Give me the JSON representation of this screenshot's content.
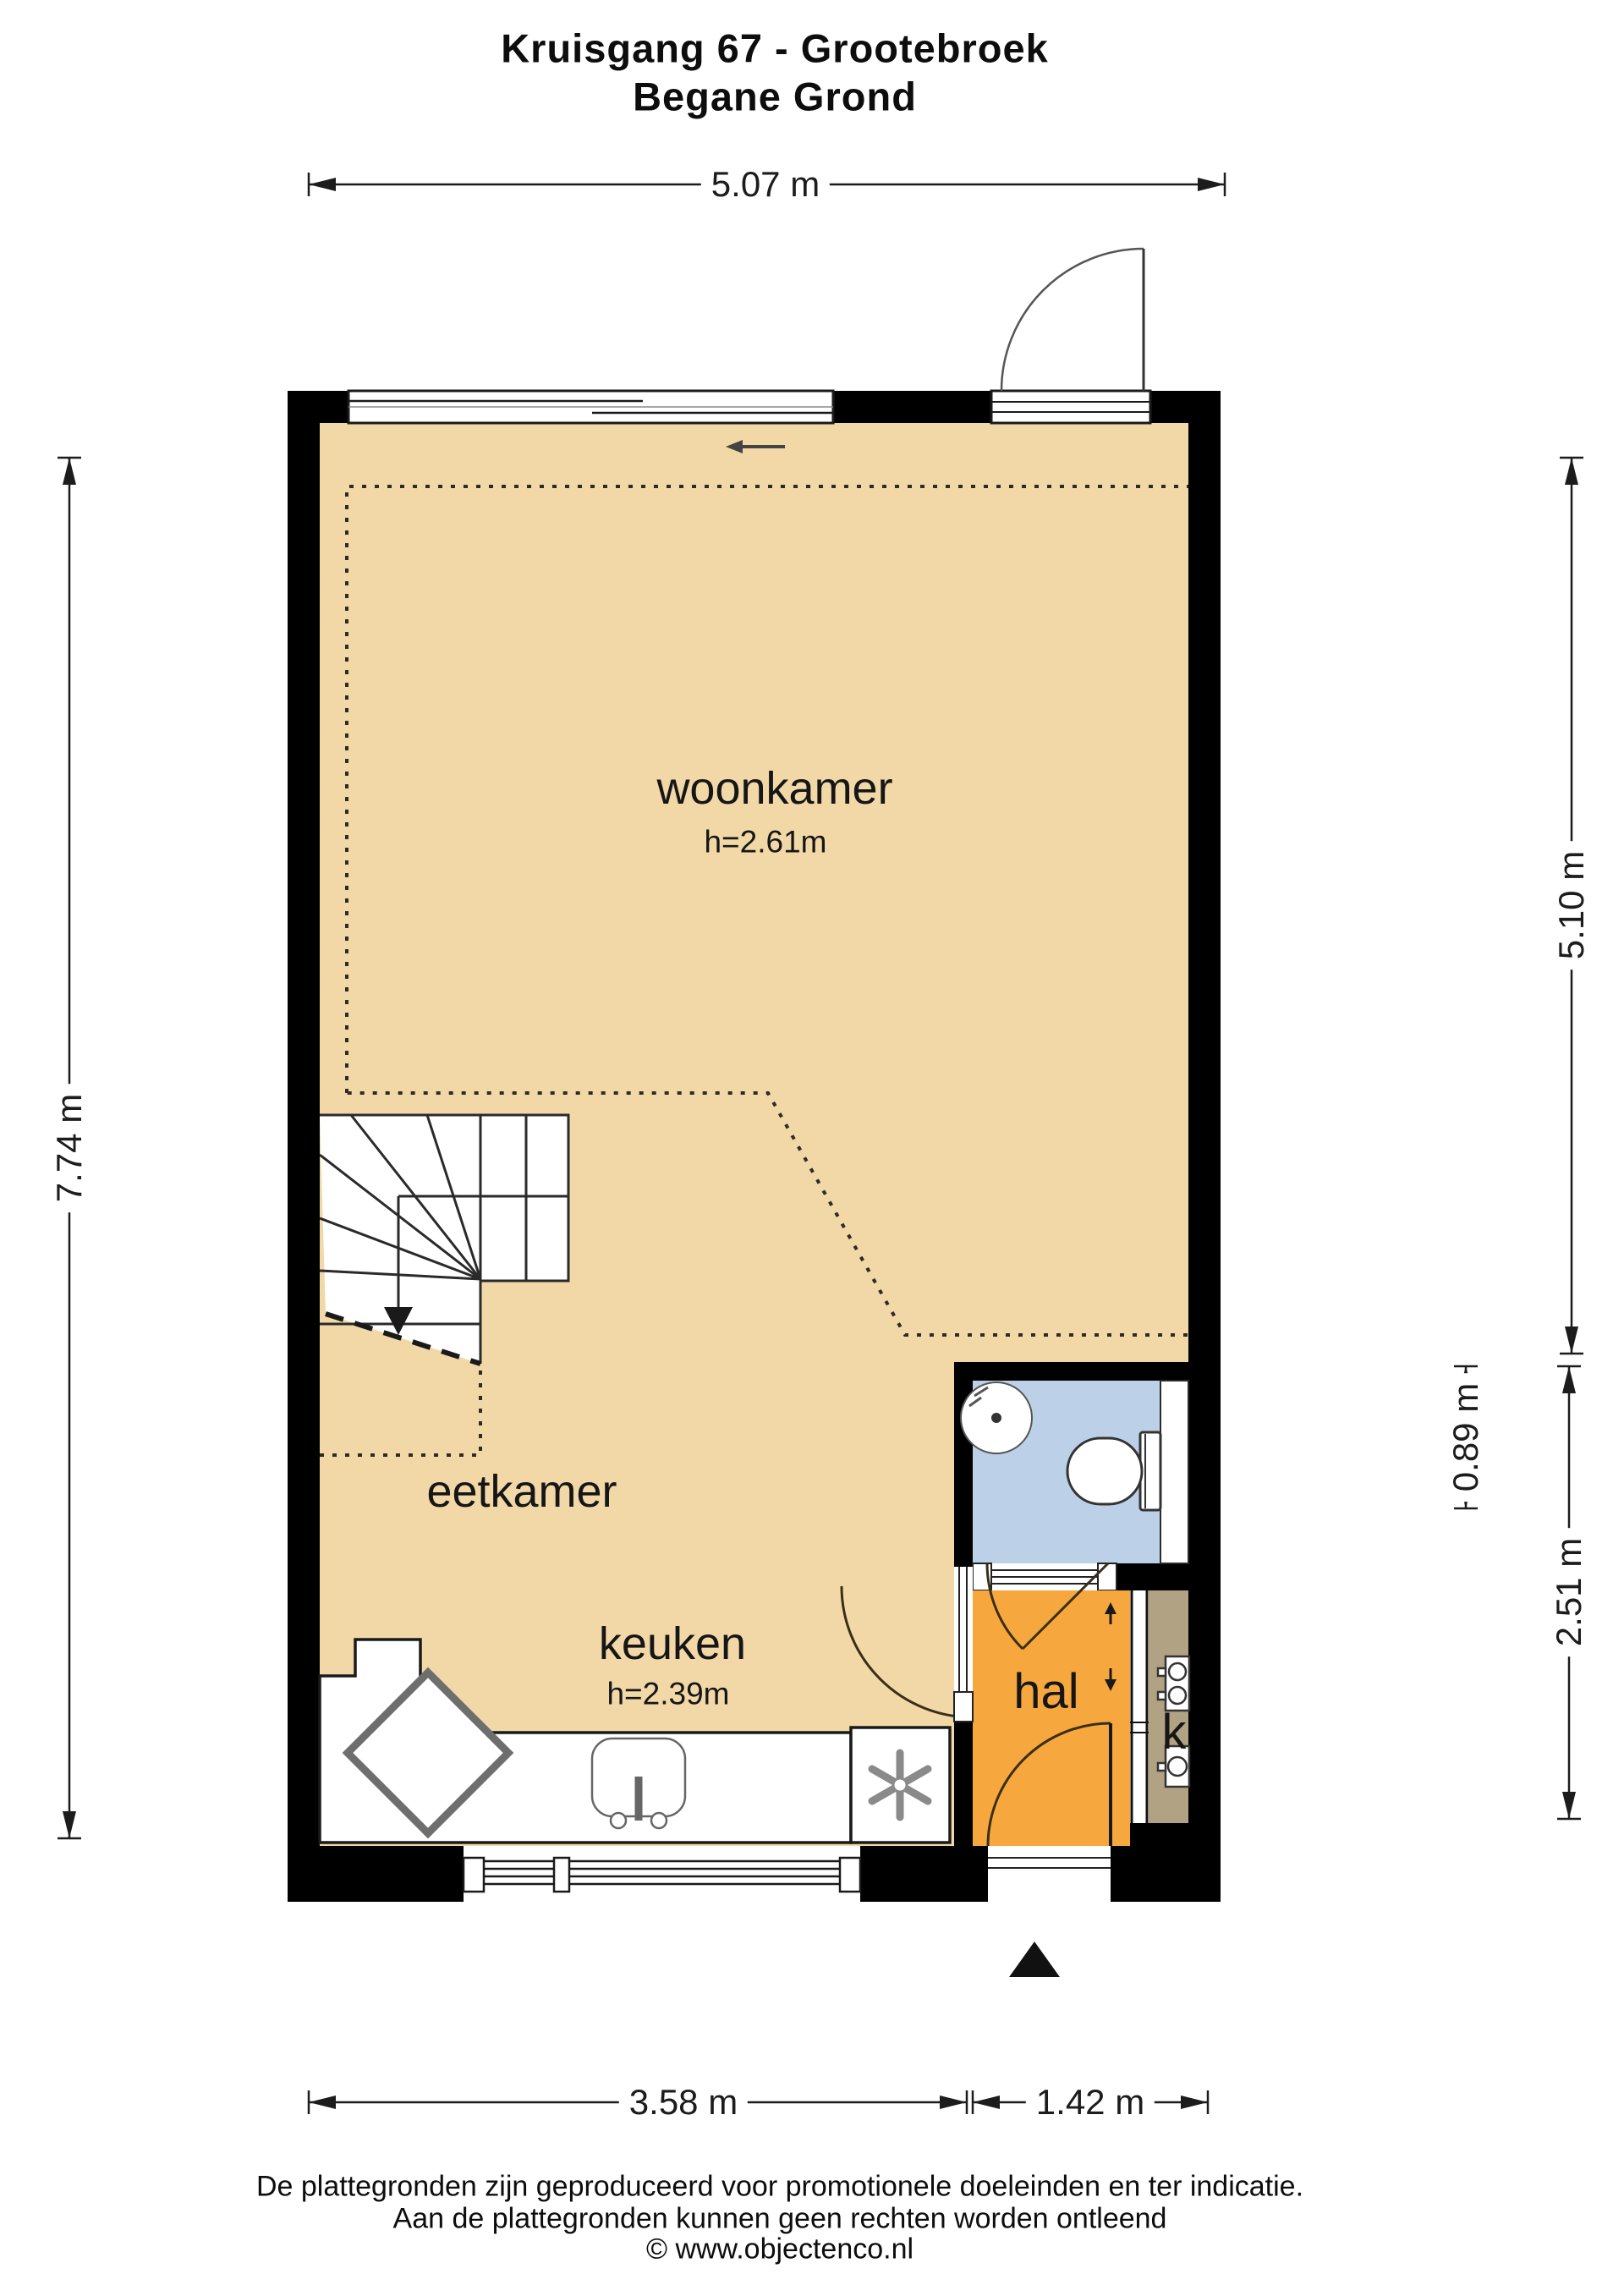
{
  "title": {
    "line1": "Kruisgang 67 - Grootebroek",
    "line2": "Begane Grond"
  },
  "rooms": {
    "woonkamer": {
      "name": "woonkamer",
      "ceiling_height": "h=2.61m"
    },
    "eetkamer": {
      "name": "eetkamer"
    },
    "keuken": {
      "name": "keuken",
      "ceiling_height": "h=2.39m"
    },
    "hal": {
      "name": "hal"
    },
    "meterkast": {
      "name": "k"
    }
  },
  "dimensions": {
    "top_width": "5.07 m",
    "left_height": "7.74 m",
    "right_upper": "5.10 m",
    "right_small": "0.89 m",
    "right_lower": "2.51 m",
    "bottom_left": "3.58 m",
    "bottom_right": "1.42 m"
  },
  "footer": {
    "line1": "De plattegronden zijn geproduceerd voor promotionele doeleinden en ter indicatie.",
    "line2": "Aan de plattegronden kunnen geen rechten worden ontleend",
    "line3": "© www.objectenco.nl"
  },
  "colors": {
    "floor": "#f2d8a7",
    "hall": "#f6a83e",
    "closet": "#b2a284",
    "bathroom": "#bcd0e8",
    "wall": "#000000",
    "line": "#1a1a1a"
  }
}
